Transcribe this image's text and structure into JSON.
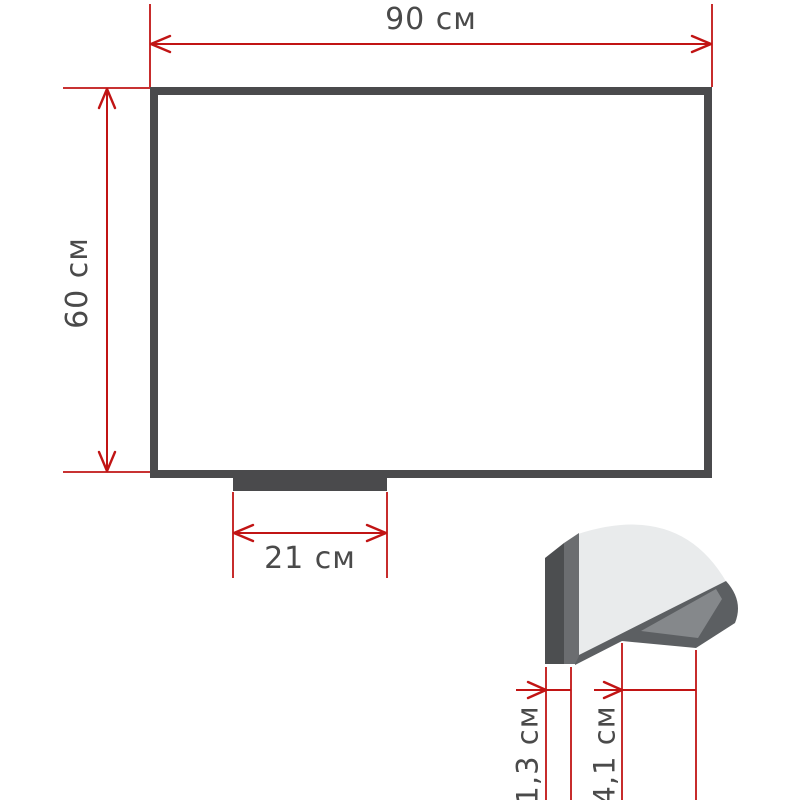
{
  "labels": {
    "board_width": "90 см",
    "board_height": "60 см",
    "tray_width": "21 см",
    "frame_depth": "1,3 см",
    "tray_depth": "4,1 см"
  },
  "colors": {
    "background": "#ffffff",
    "dimension_red": "#c11414",
    "label_gray": "#4a4a4a",
    "frame_dark": "#4a4a4c",
    "board_fill": "#ffffff",
    "profile_front": "#4c4e50",
    "profile_side": "#6b6d70",
    "surface_light": "#e9ebec",
    "tray_outer": "#5c5f62",
    "tray_inner": "#85888b"
  }
}
